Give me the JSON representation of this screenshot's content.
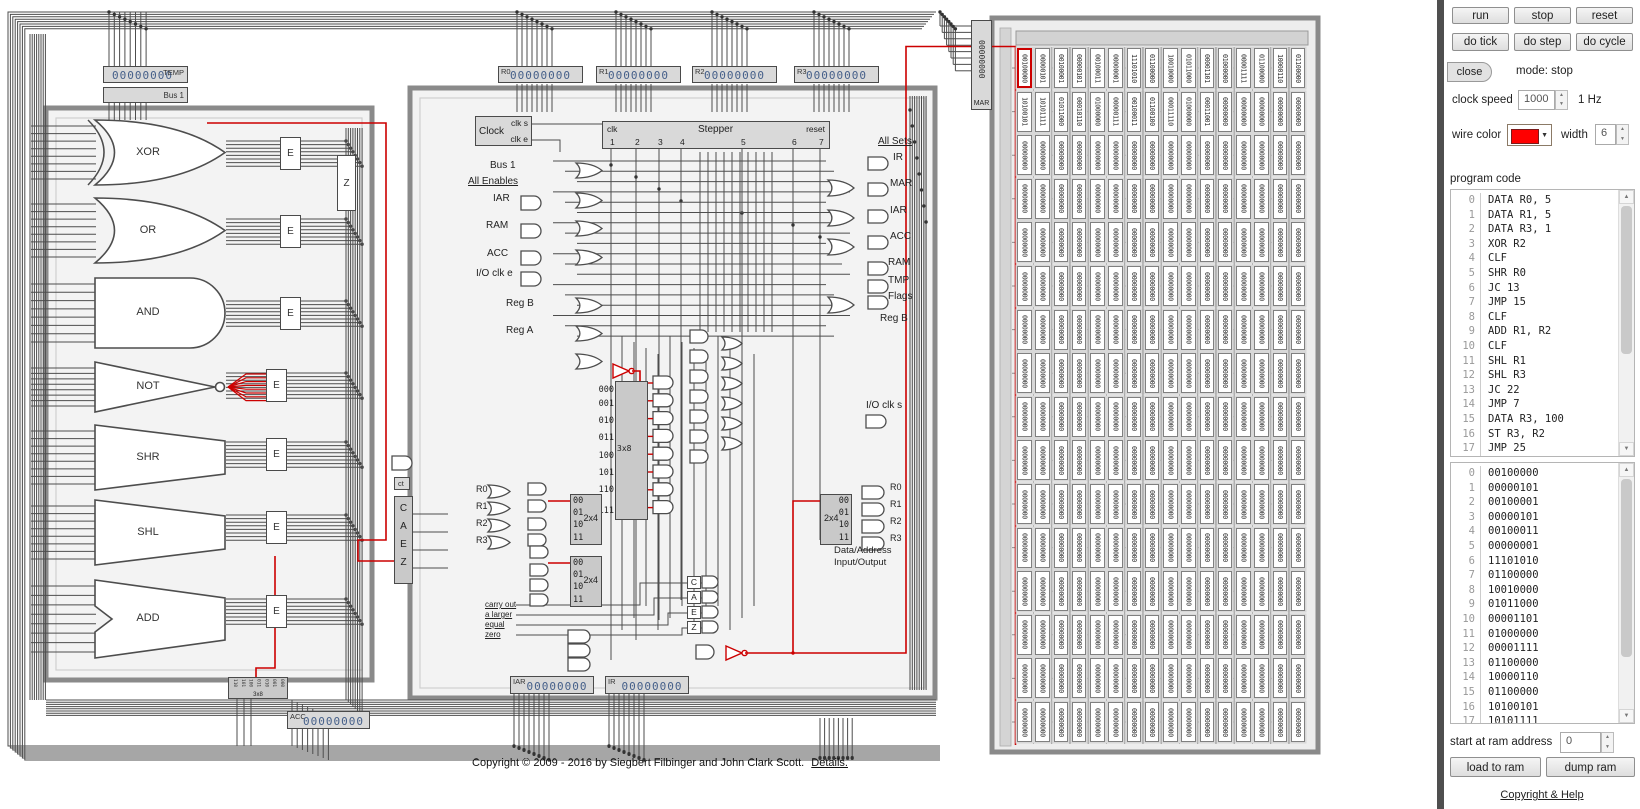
{
  "colors": {
    "wire": "#4d4d4d",
    "highlight": "#cc0000",
    "frame": "#8a8a8a",
    "register_value": "#46608a",
    "wire_color_setting": "#ff0000"
  },
  "diagram": {
    "temp": {
      "label": "TEMP",
      "value": "00000000"
    },
    "bus1": {
      "label": "Bus 1"
    },
    "regs": [
      {
        "label": "R0",
        "value": "00000000"
      },
      {
        "label": "R1",
        "value": "00000000"
      },
      {
        "label": "R2",
        "value": "00000000"
      },
      {
        "label": "R3",
        "value": "00000000"
      }
    ],
    "iar": {
      "label": "IAR",
      "value": "00000000"
    },
    "ir": {
      "label": "IR",
      "value": "00000000"
    },
    "acc": {
      "label": "ACC",
      "value": "00000000"
    },
    "mar": {
      "label": "MAR",
      "value": "00000000"
    },
    "clock": {
      "title": "Clock",
      "clk_s": "clk s",
      "clk_e": "clk e"
    },
    "stepper": {
      "title": "Stepper",
      "clk": "clk",
      "reset": "reset",
      "steps": [
        "1",
        "2",
        "3",
        "4",
        "5",
        "6",
        "7"
      ]
    },
    "enables": {
      "heading": "All Enables",
      "bus1": "Bus 1",
      "iar": "IAR",
      "ram": "RAM",
      "acc": "ACC",
      "io": "I/O clk e",
      "regb": "Reg B",
      "rega": "Reg A"
    },
    "sets": {
      "heading": "All Sets",
      "ir": "IR",
      "mar": "MAR",
      "iar": "IAR",
      "acc": "ACC",
      "ram": "RAM",
      "tmp": "TMP",
      "flags": "Flags",
      "regb": "Reg B"
    },
    "alu": {
      "gates": [
        "XOR",
        "OR",
        "AND",
        "NOT",
        "SHR",
        "SHL",
        "ADD"
      ],
      "enable": "E",
      "zero": "Z",
      "encoder": "3x8",
      "encoder_bits": [
        "110",
        "101",
        "100",
        "011",
        "010",
        "001",
        "000"
      ]
    },
    "dec3x8": {
      "label": "3x8",
      "outputs": [
        "000",
        "001",
        "010",
        "011",
        "100",
        "101",
        "110",
        "111"
      ]
    },
    "dec2x4": {
      "label": "2x4",
      "outputs": [
        "00",
        "01",
        "10",
        "11"
      ]
    },
    "regsel": [
      "R0",
      "R1",
      "R2",
      "R3"
    ],
    "io": {
      "clk_s": "I/O clk s",
      "line1": "Data/Address",
      "line2": "Input/Output"
    },
    "flags": {
      "ct": "ct",
      "letters": [
        "C",
        "A",
        "E",
        "Z"
      ],
      "conditions": [
        "carry out",
        "a larger",
        "equal",
        "zero"
      ]
    },
    "copyright": {
      "text": "Copyright © 2009 - 2016 by Siegbert Filbinger and John Clark Scott.",
      "link": "Details."
    }
  },
  "ram": {
    "rows": 16,
    "cols": 16,
    "fill": "00000000",
    "active_cell": 0,
    "values": [
      "00100000",
      "00000101",
      "00100001",
      "00000101",
      "00100011",
      "00000001",
      "11101010",
      "01100000",
      "10010000",
      "01011000",
      "00001101",
      "01000000",
      "00001111",
      "01100000",
      "10000110",
      "01100000",
      "10100101",
      "10101111",
      "01011000",
      "00010110",
      "01000000",
      "00000111",
      "00100011",
      "01100100",
      "00011110",
      "01000000",
      "00011001"
    ]
  },
  "panel": {
    "buttons": {
      "run": "run",
      "stop": "stop",
      "reset": "reset",
      "do_tick": "do tick",
      "do_step": "do step",
      "do_cycle": "do cycle",
      "close": "close",
      "load": "load to ram",
      "dump": "dump ram"
    },
    "mode": "mode: stop",
    "clock_speed": {
      "label": "clock speed",
      "value": "1000",
      "rate": "1 Hz"
    },
    "wire": {
      "label": "wire color",
      "width_label": "width",
      "width": "6"
    },
    "program": {
      "label": "program code",
      "lines": [
        {
          "n": "0",
          "code": "DATA R0, 5"
        },
        {
          "n": "1",
          "code": "DATA R1, 5"
        },
        {
          "n": "2",
          "code": "DATA R3, 1"
        },
        {
          "n": "3",
          "code": "XOR R2"
        },
        {
          "n": "4",
          "code": "CLF"
        },
        {
          "n": "5",
          "code": "SHR R0"
        },
        {
          "n": "6",
          "code": "JC 13"
        },
        {
          "n": "7",
          "code": "JMP 15"
        },
        {
          "n": "8",
          "code": "CLF"
        },
        {
          "n": "9",
          "code": "ADD R1, R2"
        },
        {
          "n": "10",
          "code": "CLF"
        },
        {
          "n": "11",
          "code": "SHL R1"
        },
        {
          "n": "12",
          "code": "SHL R3"
        },
        {
          "n": "13",
          "code": "JC 22"
        },
        {
          "n": "14",
          "code": "JMP 7"
        },
        {
          "n": "15",
          "code": "DATA R3, 100"
        },
        {
          "n": "16",
          "code": "ST R3, R2"
        },
        {
          "n": "17",
          "code": "JMP 25"
        }
      ]
    },
    "start_addr": {
      "label": "start at ram address",
      "value": "0"
    },
    "help_link": "Copyright & Help"
  }
}
